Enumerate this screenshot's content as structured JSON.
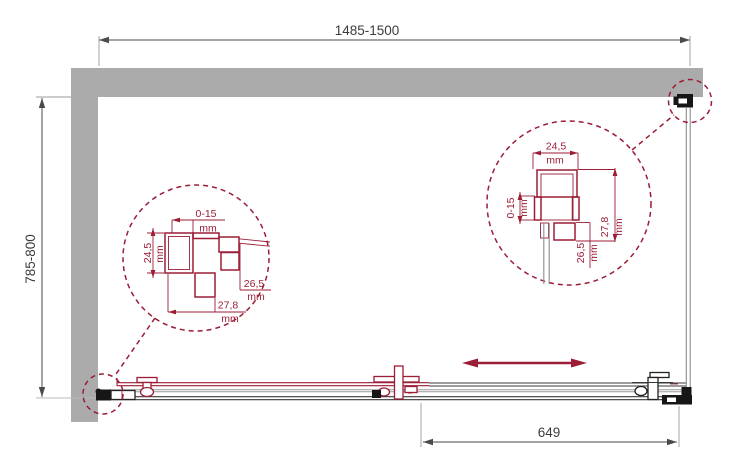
{
  "drawing": {
    "overall_dimensions": {
      "width_label": "1485-1500",
      "depth_label": "785-800",
      "panel_width_label": "649"
    },
    "detail_left": {
      "dims": [
        {
          "value": "0-15",
          "unit": "mm"
        },
        {
          "value": "24,5",
          "unit": "mm"
        },
        {
          "value": "26,5",
          "unit": "mm"
        },
        {
          "value": "27,8",
          "unit": "mm"
        }
      ]
    },
    "detail_right": {
      "dims": [
        {
          "value": "24,5",
          "unit": "mm"
        },
        {
          "value": "0-15",
          "unit": "mm"
        },
        {
          "value": "27,8",
          "unit": "mm"
        },
        {
          "value": "26,5",
          "unit": "mm"
        }
      ]
    },
    "icons": {
      "slide_direction": "double-headed-horizontal-arrow",
      "detail_callout": "dashed-circle-callout"
    },
    "colors": {
      "accent_red": "#9B1D36",
      "wall_gray": "#ABABAB",
      "line_dark": "#3A3A3A",
      "line_gray": "#8A8A8A",
      "dim_line": "#4A4A4A",
      "dim_text": "#3C3C3C"
    }
  }
}
